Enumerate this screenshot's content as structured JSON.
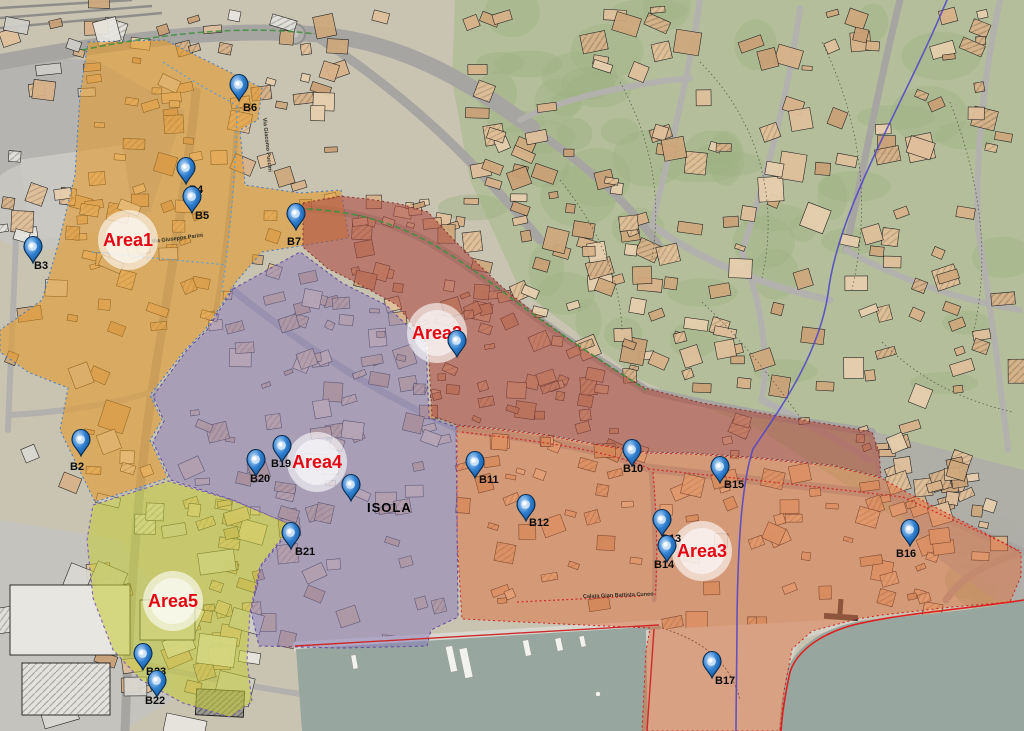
{
  "map": {
    "area_label_color": "#e30613",
    "area_labels": [
      {
        "id": "area1",
        "label": "Area1",
        "x": 128,
        "y": 240
      },
      {
        "id": "area2",
        "label": "Area2",
        "x": 437,
        "y": 333
      },
      {
        "id": "area3",
        "label": "Area3",
        "x": 702,
        "y": 551
      },
      {
        "id": "area4",
        "label": "Area4",
        "x": 317,
        "y": 462
      },
      {
        "id": "area5",
        "label": "Area5",
        "x": 173,
        "y": 601
      }
    ],
    "markers": [
      {
        "id": "B2",
        "label": "B2",
        "x": 81,
        "y": 456,
        "lx": 70,
        "ly": 470
      },
      {
        "id": "B3",
        "label": "B3",
        "x": 33,
        "y": 263,
        "lx": 34,
        "ly": 269
      },
      {
        "id": "B4",
        "label": "B4",
        "x": 186,
        "y": 184,
        "lx": 189,
        "ly": 193
      },
      {
        "id": "B5",
        "label": "B5",
        "x": 192,
        "y": 213,
        "lx": 195,
        "ly": 219
      },
      {
        "id": "B6",
        "label": "B6",
        "x": 239,
        "y": 101,
        "lx": 243,
        "ly": 111
      },
      {
        "id": "B7",
        "label": "B7",
        "x": 296,
        "y": 230,
        "lx": 287,
        "ly": 245
      },
      {
        "id": "B8",
        "label": "",
        "x": 457,
        "y": 357,
        "lx": 0,
        "ly": 0
      },
      {
        "id": "B10",
        "label": "B10",
        "x": 632,
        "y": 466,
        "lx": 623,
        "ly": 472
      },
      {
        "id": "B11",
        "label": "B11",
        "x": 475,
        "y": 478,
        "lx": 479,
        "ly": 483
      },
      {
        "id": "B12",
        "label": "B12",
        "x": 526,
        "y": 521,
        "lx": 529,
        "ly": 526
      },
      {
        "id": "B13",
        "label": "B13",
        "x": 662,
        "y": 536,
        "lx": 661,
        "ly": 542
      },
      {
        "id": "B14",
        "label": "B14",
        "x": 667,
        "y": 562,
        "lx": 654,
        "ly": 568
      },
      {
        "id": "B15",
        "label": "B15",
        "x": 720,
        "y": 483,
        "lx": 724,
        "ly": 488
      },
      {
        "id": "B16",
        "label": "B16",
        "x": 910,
        "y": 546,
        "lx": 896,
        "ly": 557
      },
      {
        "id": "B17",
        "label": "B17",
        "x": 712,
        "y": 678,
        "lx": 715,
        "ly": 684
      },
      {
        "id": "B19",
        "label": "B19",
        "x": 282,
        "y": 462,
        "lx": 271,
        "ly": 467
      },
      {
        "id": "B20",
        "label": "B20",
        "x": 256,
        "y": 476,
        "lx": 250,
        "ly": 482
      },
      {
        "id": "B21",
        "label": "B21",
        "x": 291,
        "y": 549,
        "lx": 295,
        "ly": 555
      },
      {
        "id": "B23",
        "label": "B23",
        "x": 143,
        "y": 670,
        "lx": 146,
        "ly": 675
      },
      {
        "id": "B22",
        "label": "B22",
        "x": 157,
        "y": 697,
        "lx": 145,
        "ly": 704
      },
      {
        "id": "ISOLA-pin",
        "label": "",
        "x": 351,
        "y": 501,
        "lx": 0,
        "ly": 0
      }
    ],
    "place_labels": [
      {
        "label": "ISOLA",
        "x": 367,
        "y": 512
      }
    ],
    "street_labels": [
      {
        "label": "Via Giuseppe Parini",
        "x": 152,
        "y": 243,
        "rot": -7
      },
      {
        "label": "Via Giacomo Puccini",
        "x": 263,
        "y": 118,
        "rot": 84
      },
      {
        "label": "Calata Gian Battista Cuneo",
        "x": 583,
        "y": 598,
        "rot": -2,
        "color": "#5d1414"
      }
    ],
    "zone_colors": {
      "area1": "#e69a28",
      "area2": "#ad4f45",
      "area3": "#e0703e",
      "area4": "#8d81bb",
      "area5": "#c6cc3a"
    }
  }
}
